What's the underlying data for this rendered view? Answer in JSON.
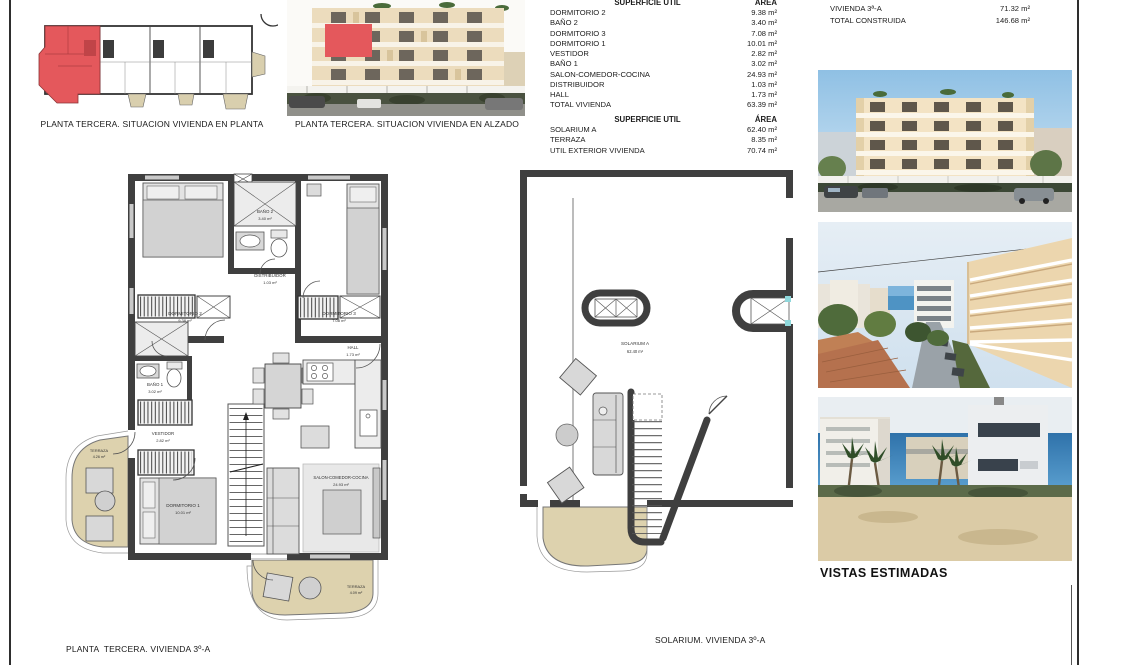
{
  "captions": {
    "situacion_planta": "PLANTA TERCERA. SITUACION VIVIENDA EN PLANTA",
    "situacion_alzado": "PLANTA TERCERA. SITUACION VIVIENDA EN ALZADO",
    "planta_vivienda": "PLANTA  TERCERA. VIVIENDA 3º-A",
    "solarium_vivienda": "SOLARIUM. VIVIENDA 3º-A",
    "vistas_estimadas": "VISTAS ESTIMADAS"
  },
  "tabla_util_vivienda": {
    "header": {
      "label": "SUPERFICIE UTIL",
      "area": "ÁREA"
    },
    "rows": [
      {
        "label": "DORMITORIO 2",
        "value": "9.38 m²"
      },
      {
        "label": "BAÑO 2",
        "value": "3.40 m²"
      },
      {
        "label": "DORMITORIO 3",
        "value": "7.08 m²"
      },
      {
        "label": "DORMITORIO 1",
        "value": "10.01 m²"
      },
      {
        "label": "VESTIDOR",
        "value": "2.82 m²"
      },
      {
        "label": "BAÑO 1",
        "value": "3.02 m²"
      },
      {
        "label": "SALON-COMEDOR-COCINA",
        "value": "24.93 m²"
      },
      {
        "label": "DISTRIBUIDOR",
        "value": "1.03 m²"
      },
      {
        "label": "HALL",
        "value": "1.73 m²"
      },
      {
        "label": "TOTAL VIVIENDA",
        "value": "63.39 m²"
      }
    ]
  },
  "tabla_util_exterior": {
    "header": {
      "label": "SUPERFICIE UTIL",
      "area": "ÁREA"
    },
    "rows": [
      {
        "label": "SOLARIUM A",
        "value": "62.40 m²"
      },
      {
        "label": "TERRAZA",
        "value": "8.35 m²"
      },
      {
        "label": "UTIL EXTERIOR VIVIENDA",
        "value": "70.74 m²"
      }
    ]
  },
  "tabla_construida": {
    "rows": [
      {
        "label": "CONSTRUIDA TERRAZA",
        "value": "8.32 m²"
      },
      {
        "label": "VIVIENDA 3ª-A",
        "value": "71.32 m²"
      },
      {
        "label": "TOTAL CONSTRUIDA",
        "value": "146.68 m²"
      }
    ]
  },
  "plan_rooms": {
    "dormitorio2": {
      "name": "DORMITORIO 2",
      "area": "9.38 m²"
    },
    "bano2": {
      "name": "BAÑO 2",
      "area": "3.40 m²"
    },
    "dormitorio3": {
      "name": "DORMITORIO 3",
      "area": "7.08 m²"
    },
    "distribuidor": {
      "name": "DISTRIBUIDOR",
      "area": "1.03 m²"
    },
    "hall": {
      "name": "HALL",
      "area": "1.73 m²"
    },
    "bano1": {
      "name": "BAÑO 1",
      "area": "3.02 m²"
    },
    "vestidor": {
      "name": "VESTIDOR",
      "area": "2.82 m²"
    },
    "terraza_oeste": {
      "name": "TERRAZA",
      "area": "4.26 m²"
    },
    "dormitorio1": {
      "name": "DORMITORIO 1",
      "area": "10.01 m²"
    },
    "salon": {
      "name": "SALON-COMEDOR-COCINA",
      "area": "24.93 m²"
    },
    "terraza_sur": {
      "name": "TERRAZA",
      "area": "4.09 m²"
    }
  },
  "solarium_room": {
    "name": "SOLARIUM A",
    "area": "62.40 m²"
  },
  "colors": {
    "highlight_red": "#e4585c",
    "terrace_beige": "#ddd2ae",
    "wall_dark": "#3f3f3f"
  }
}
